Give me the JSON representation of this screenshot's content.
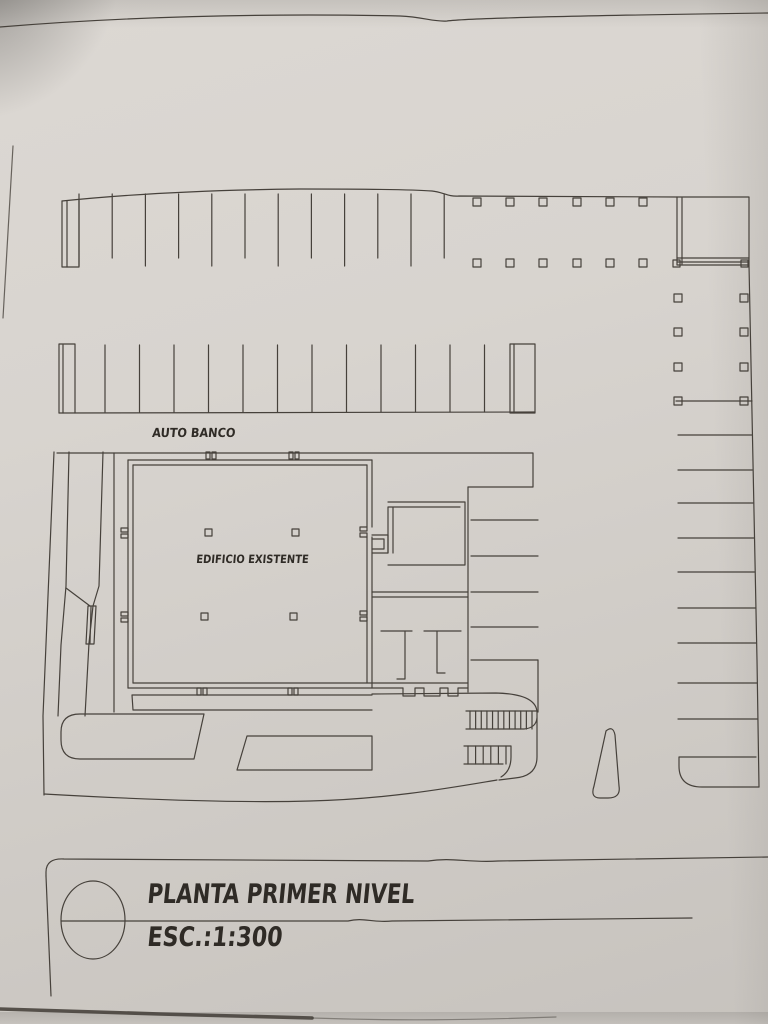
{
  "drawing": {
    "kind": "architectural-site-plan-scan",
    "labels": {
      "auto_banco": "AUTO BANCO",
      "building": "EDIFICIO EXISTENTE"
    },
    "title_block": {
      "title": "PLANTA PRIMER NIVEL",
      "scale": "ESC.:1:300",
      "symbol": "circle-with-horizontal-line"
    },
    "colors": {
      "paper": "#d6d2cd",
      "ink": "#46413b",
      "text_ink": "#2f2b26",
      "edge_shadow": "#55504a"
    }
  },
  "plan": {
    "band1": {
      "divider_xs_start": 79,
      "divider_step": 33.2,
      "divider_count": 12,
      "y_top": 194,
      "y_long": 266,
      "y_short": 258
    },
    "band1_cols": {
      "xs": [
        477,
        510,
        543,
        577,
        610,
        643
      ],
      "row_ys": [
        198,
        259
      ],
      "size": 8
    },
    "right_cols": {
      "x_pair": [
        674,
        740
      ],
      "row_ys": [
        294,
        328,
        363,
        397
      ],
      "size": 8
    },
    "band2": {
      "divider_xs_start": 105,
      "divider_step": 34.5,
      "divider_count": 12,
      "y_top": 345,
      "y_bottom": 412
    },
    "right_stalls": {
      "ys": [
        435,
        470,
        503,
        538,
        572,
        608,
        643,
        683,
        719
      ],
      "x_start": 678
    },
    "mid_stalls": {
      "ys": [
        520,
        556,
        592,
        627,
        660
      ],
      "x1": 471,
      "x2": 538
    },
    "building_cols": {
      "pts": [
        [
          205,
          529
        ],
        [
          292,
          529
        ],
        [
          201,
          613
        ],
        [
          290,
          613
        ]
      ],
      "size": 7
    },
    "hatch1": {
      "x1": 470,
      "x2": 532,
      "count": 12,
      "y1": 711,
      "y2": 729
    },
    "hatch2": {
      "x1": 468,
      "x2": 506,
      "count": 6,
      "y1": 746,
      "y2": 764
    }
  }
}
